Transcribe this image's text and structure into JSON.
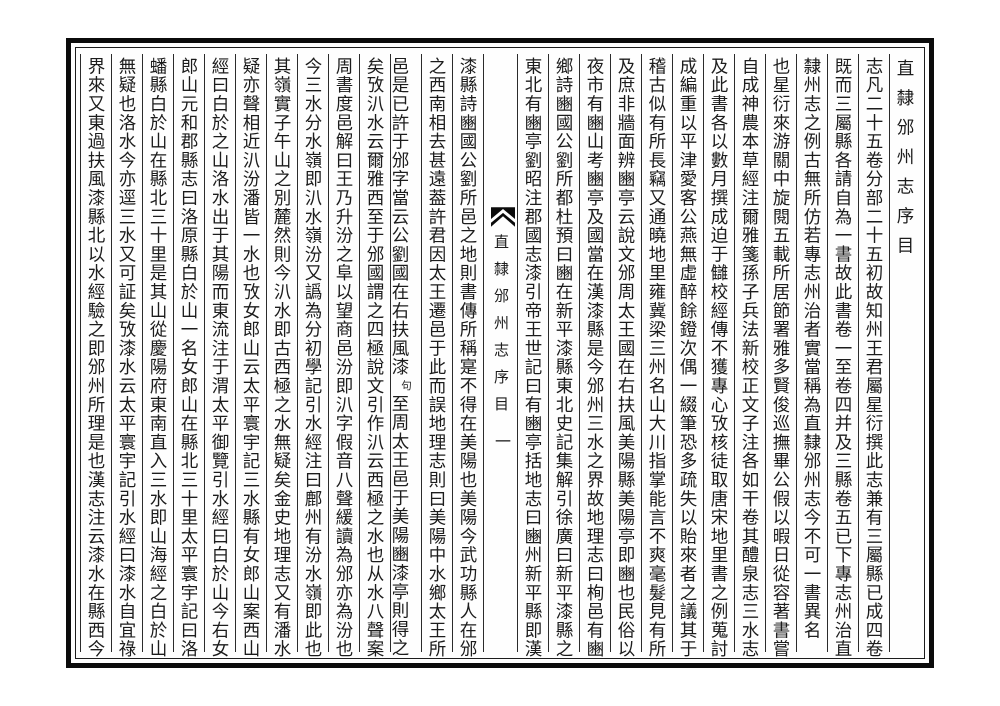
{
  "colors": {
    "paper": "#ffffff",
    "ink": "#1c1c1c",
    "border": "#000000"
  },
  "book": {
    "header_title": "直隸邠州志序目",
    "center": {
      "fishtail_icon": "fishtail-icon",
      "title": "直隸邠州志序目",
      "page_number": "一"
    },
    "right_columns": [
      "志凡二十五卷分部二十五初故知州王君屬星衍撰此志兼有三屬縣已成四卷",
      "既而三屬縣各請自為一書故此書卷一至卷四并及三縣卷五已下專志州治直",
      "隸州志之例古無所仿若專志州治者實當稱為直隸邠州志今不可一書異名",
      "也星衍來游關中旋閱五載所居節署雅多賢俊巡撫畢公假以暇日從容著書嘗",
      "自成神農本草經注爾雅箋孫子兵法新校正文子注各如干卷其醴泉志三水志",
      "及此書各以數月撰成迫于讎校經傳不獲專心攷核徒取唐宋地里書之例蒐討",
      "成編重以平津愛客公燕無虛醉餘鐙次偶一綴筆恐多疏失以貽來者之議其于",
      "稽古似有所長竊又通曉地里雍冀梁三州名山大川指掌能言不爽毫髮見有所",
      "及庶非牆面辨豳亭云說文邠周太王國在右扶風美陽縣美陽亭即豳也民俗以",
      "夜市有豳山考豳亭及國當在漢漆縣是今邠州三水之界故地理志曰栒邑有豳",
      "鄉詩豳國公劉所都杜預曰豳在新平漆縣東北史記集解引徐廣曰新平漆縣之",
      "東北有豳亭劉昭注郡國志漆引帝王世記曰有豳亭括地志曰豳州新平縣即漢"
    ],
    "special_column": {
      "pre": "邑是已許于邠字當云公劉國在右扶風漆",
      "note": "句",
      "post": "至周太王邑于美陽豳漆亭則得之"
    },
    "left_columns": [
      "漆縣詩豳國公劉所邑之地則書傳所稱寔不得在美陽也美陽今武功縣人在邠",
      "之西南相去甚遠葢許君因太王遷邑于此而誤地理志則曰美陽中水鄉太王所",
      "矣攷汃水云爾雅西至于邠國謂之四極說文引作汃云西極之水也从水八聲案",
      "周書度邑解曰王乃升汾之阜以望商邑汾即汃字假音八聲緩讀為邠亦為汾也",
      "今三水分水嶺即汃水嶺汾又譌為分初學記引水經注曰鄜州有汾水嶺即此也",
      "其嶺實子午山之別麓然則今汃水即古西極之水無疑矣金史地理志又有潘水",
      "疑亦聲相近汃汾潘皆一水也攷女郎山云太平寰宇記三水縣有女郎山案西山",
      "經曰白於之山洛水出于其陽而東流注于渭太平御覽引水經曰白於山今右女",
      "郎山元和郡縣志曰洛原縣白於山一名女郎山在縣北三十里太平寰宇記曰洛",
      "蟠縣白於山在縣北三十里是其山從慶陽府東南直入三水即山海經之白於山",
      "無疑也洛水今亦逕三水又可証矣攷漆水云太平寰宇記引水經曰漆水自宜祿",
      "界來又東過扶風漆縣北以水經驗之即邠州所理是也漢志注云漆水在縣西今"
    ]
  }
}
